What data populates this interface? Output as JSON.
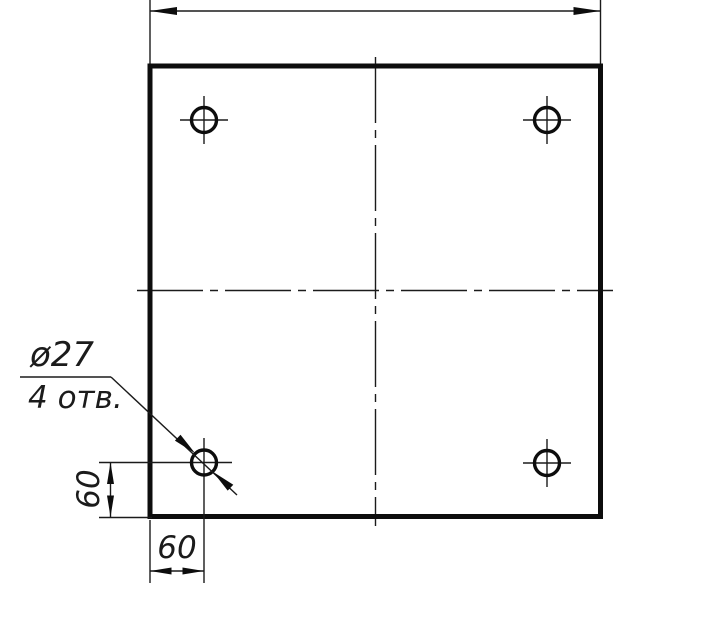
{
  "canvas": {
    "background": "#ffffff",
    "line_color": "#0d0d0d",
    "kind": "engineering-drawing-plate-top-view"
  },
  "drawing": {
    "leader": {
      "diameter_label": "ø27",
      "count_label": "4 отв."
    },
    "dimensions": {
      "left_vertical_label": "60",
      "bottom_horizontal_label": "60"
    },
    "holes": {
      "count": 4,
      "diameter_value": 27,
      "edge_offset_value": 60
    }
  }
}
